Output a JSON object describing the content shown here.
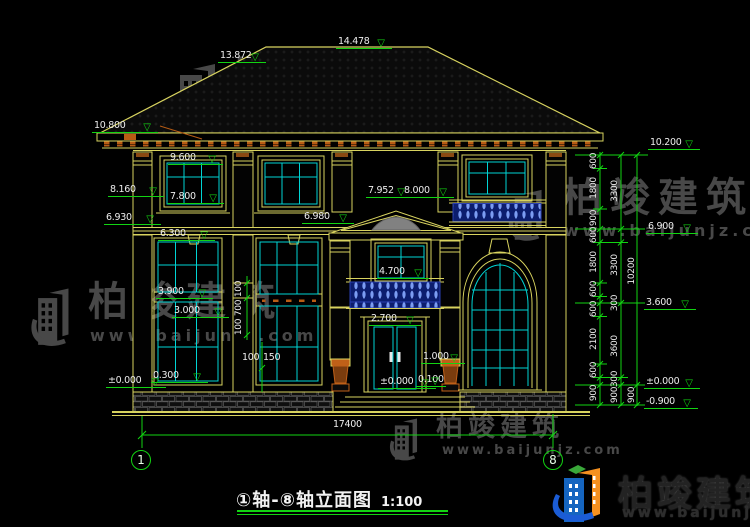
{
  "title": {
    "text": "①轴-⑧轴立面图",
    "scale": "1:100"
  },
  "watermark": {
    "brand": "柏竣建筑",
    "url": "www.baijunjz.com"
  },
  "glyphs": {
    "level_triangle": "▽"
  },
  "axis_bubbles": [
    {
      "label": "1",
      "x": 131,
      "y": 450
    },
    {
      "label": "8",
      "x": 543,
      "y": 450
    }
  ],
  "markers": [
    {
      "label": "13.872",
      "x": 218,
      "y": 43,
      "w": 48
    },
    {
      "label": "14.478",
      "x": 336,
      "y": 29,
      "w": 56
    },
    {
      "label": "10.800",
      "x": 92,
      "y": 113,
      "w": 66
    },
    {
      "label": "9.600",
      "x": 168,
      "y": 145,
      "w": 55
    },
    {
      "label": "8.160",
      "x": 108,
      "y": 177,
      "w": 56
    },
    {
      "label": "7.800",
      "x": 168,
      "y": 184,
      "w": 56
    },
    {
      "label": "6.930",
      "x": 104,
      "y": 205,
      "w": 57
    },
    {
      "label": "6.300",
      "x": 158,
      "y": 221,
      "w": 57
    },
    {
      "label": "3.900",
      "x": 156,
      "y": 279,
      "w": 57
    },
    {
      "label": "3.000",
      "x": 172,
      "y": 298,
      "w": 57
    },
    {
      "label": "0.300",
      "x": 151,
      "y": 363,
      "w": 57
    },
    {
      "label": "±0.000",
      "x": 106,
      "y": 368,
      "w": 60
    },
    {
      "label": "7.952",
      "x": 366,
      "y": 178,
      "w": 46
    },
    {
      "label": "8.000",
      "x": 402,
      "y": 178,
      "w": 52
    },
    {
      "label": "6.980",
      "x": 302,
      "y": 204,
      "w": 52
    },
    {
      "label": "4.700",
      "x": 377,
      "y": 259,
      "w": 52
    },
    {
      "label": "2.700",
      "x": 369,
      "y": 306,
      "w": 52
    },
    {
      "label": "1.000",
      "x": 421,
      "y": 344,
      "w": 44
    },
    {
      "label": "±0.000",
      "x": 378,
      "y": 369,
      "w": 58
    },
    {
      "label": "0.100",
      "x": 416,
      "y": 367,
      "w": 30
    },
    {
      "label": "10.200",
      "x": 648,
      "y": 130,
      "w": 52
    },
    {
      "label": "6.900",
      "x": 646,
      "y": 214,
      "w": 52
    },
    {
      "label": "3.600",
      "x": 644,
      "y": 290,
      "w": 52
    },
    {
      "label": "±0.000",
      "x": 644,
      "y": 369,
      "w": 56
    },
    {
      "label": "-0.900",
      "x": 644,
      "y": 389,
      "w": 54
    }
  ],
  "dim_rotated": [
    {
      "label": "600",
      "x": 594,
      "y": 162
    },
    {
      "label": "1800",
      "x": 594,
      "y": 189
    },
    {
      "label": "900",
      "x": 594,
      "y": 219
    },
    {
      "label": "600",
      "x": 594,
      "y": 236
    },
    {
      "label": "1800",
      "x": 594,
      "y": 263
    },
    {
      "label": "600",
      "x": 594,
      "y": 290
    },
    {
      "label": "600",
      "x": 594,
      "y": 310
    },
    {
      "label": "2100",
      "x": 594,
      "y": 340
    },
    {
      "label": "600",
      "x": 594,
      "y": 371
    },
    {
      "label": "900",
      "x": 594,
      "y": 394
    },
    {
      "label": "3300",
      "x": 615,
      "y": 192
    },
    {
      "label": "3300",
      "x": 615,
      "y": 266
    },
    {
      "label": "300",
      "x": 615,
      "y": 304
    },
    {
      "label": "3600",
      "x": 615,
      "y": 347
    },
    {
      "label": "300",
      "x": 615,
      "y": 380
    },
    {
      "label": "900",
      "x": 615,
      "y": 396
    },
    {
      "label": "10200",
      "x": 632,
      "y": 272
    },
    {
      "label": "900",
      "x": 632,
      "y": 396
    },
    {
      "label": "100",
      "x": 239,
      "y": 290
    },
    {
      "label": "700",
      "x": 239,
      "y": 309
    },
    {
      "label": "100",
      "x": 239,
      "y": 328
    }
  ],
  "dim_flat": [
    {
      "label": "17400",
      "x": 333,
      "y": 420
    },
    {
      "label": "100",
      "x": 242,
      "y": 353
    },
    {
      "label": "150",
      "x": 263,
      "y": 353
    }
  ]
}
